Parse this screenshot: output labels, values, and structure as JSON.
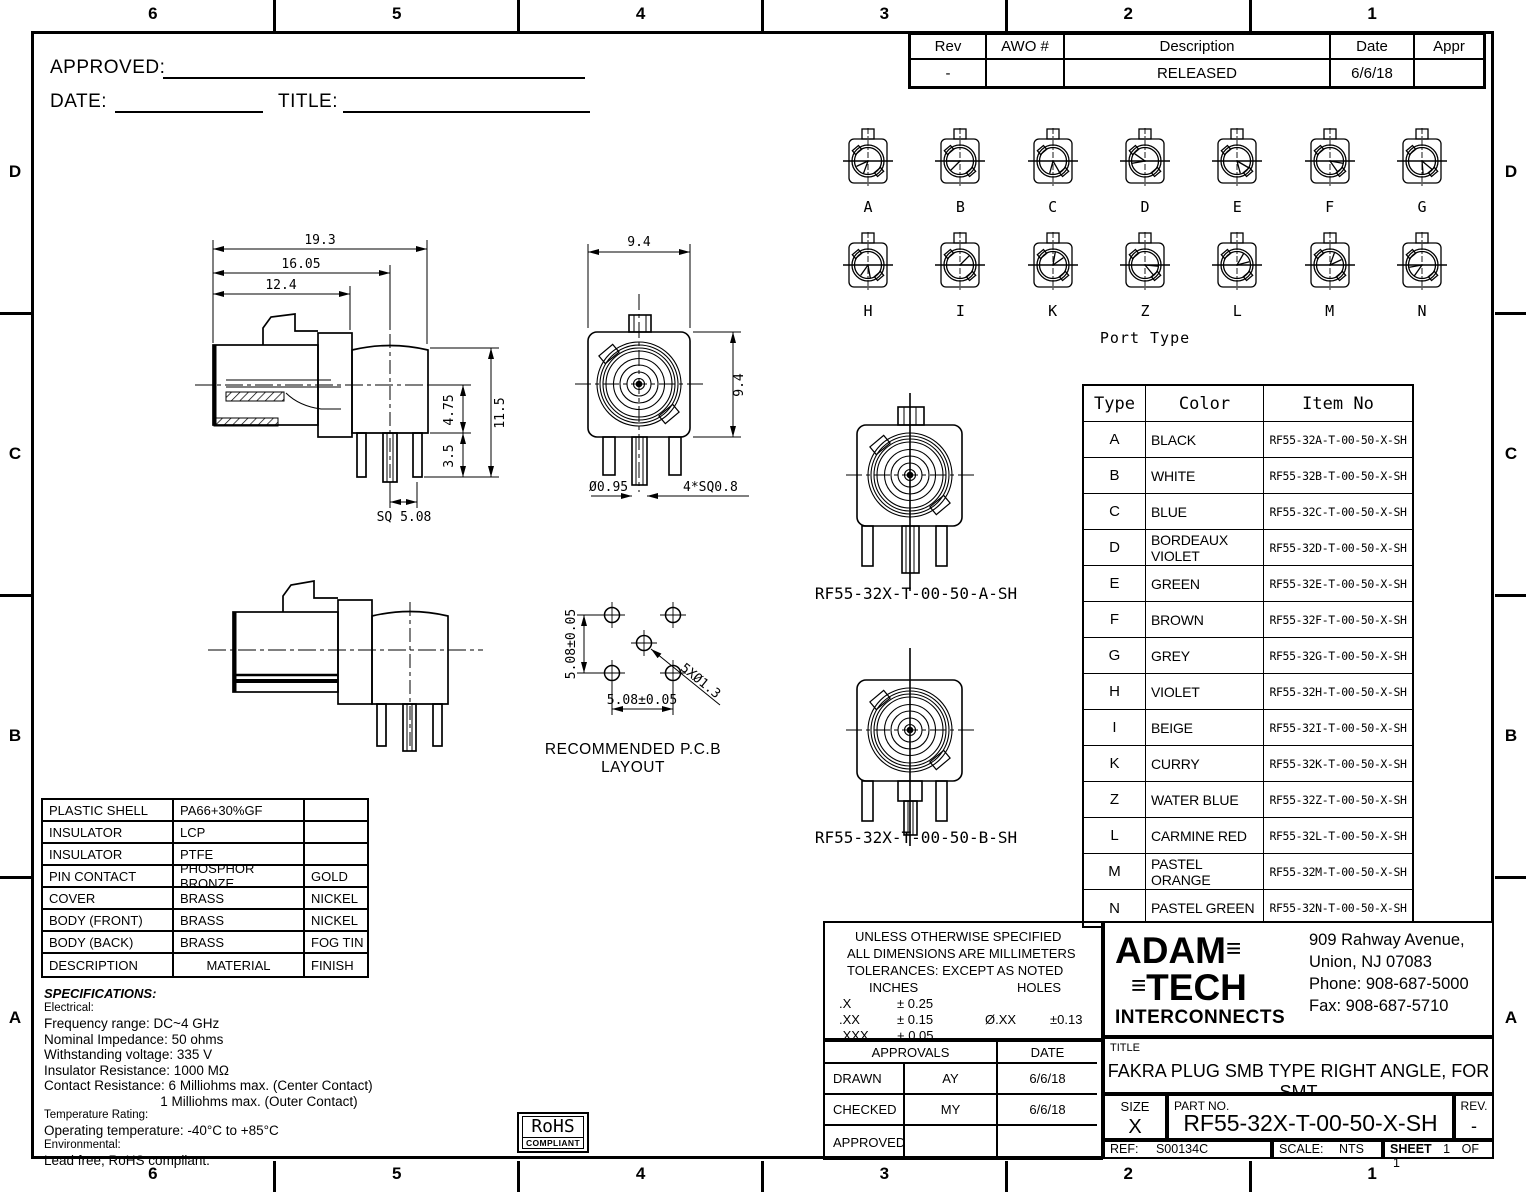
{
  "sheet": {
    "zones": {
      "cols": [
        "6",
        "5",
        "4",
        "3",
        "2",
        "1"
      ],
      "rows": [
        "D",
        "C",
        "B",
        "A"
      ]
    }
  },
  "header": {
    "approved_label": "APPROVED:",
    "date_label": "DATE:",
    "title_label": "TITLE:"
  },
  "rev_table": {
    "headers": [
      "Rev",
      "AWO #",
      "Description",
      "Date",
      "Appr"
    ],
    "rows": [
      [
        "-",
        "",
        "RELEASED",
        "6/6/18",
        ""
      ]
    ]
  },
  "port_types": {
    "caption": "Port Type",
    "row1": [
      "A",
      "B",
      "C",
      "D",
      "E",
      "F",
      "G"
    ],
    "row2": [
      "H",
      "I",
      "K",
      "Z",
      "L",
      "M",
      "N"
    ]
  },
  "dims": {
    "len_total": "19.3",
    "len_mid": "16.05",
    "len_front": "12.4",
    "h_center": "4.75",
    "h_total": "11.5",
    "leg_len": "3.5",
    "sq_pitch": "SQ 5.08",
    "fv_width": "9.4",
    "fv_height": "9.4",
    "pin_dia": "Ø0.95",
    "leg_sq": "4*SQ0.8"
  },
  "pcb": {
    "dim_v": "5.08±0.05",
    "dim_h": "5.08±0.05",
    "holes": "5XØ1.3",
    "caption": "RECOMMENDED P.C.B LAYOUT"
  },
  "variants": {
    "a_label": "RF55-32X-T-00-50-A-SH",
    "b_label": "RF55-32X-T-00-50-B-SH"
  },
  "type_table": {
    "headers": [
      "Type",
      "Color",
      "Item No"
    ],
    "rows": [
      [
        "A",
        "BLACK",
        "RF55-32A-T-00-50-X-SH"
      ],
      [
        "B",
        "WHITE",
        "RF55-32B-T-00-50-X-SH"
      ],
      [
        "C",
        "BLUE",
        "RF55-32C-T-00-50-X-SH"
      ],
      [
        "D",
        "BORDEAUX VIOLET",
        "RF55-32D-T-00-50-X-SH"
      ],
      [
        "E",
        "GREEN",
        "RF55-32E-T-00-50-X-SH"
      ],
      [
        "F",
        "BROWN",
        "RF55-32F-T-00-50-X-SH"
      ],
      [
        "G",
        "GREY",
        "RF55-32G-T-00-50-X-SH"
      ],
      [
        "H",
        "VIOLET",
        "RF55-32H-T-00-50-X-SH"
      ],
      [
        "I",
        "BEIGE",
        "RF55-32I-T-00-50-X-SH"
      ],
      [
        "K",
        "CURRY",
        "RF55-32K-T-00-50-X-SH"
      ],
      [
        "Z",
        "WATER BLUE",
        "RF55-32Z-T-00-50-X-SH"
      ],
      [
        "L",
        "CARMINE RED",
        "RF55-32L-T-00-50-X-SH"
      ],
      [
        "M",
        "PASTEL ORANGE",
        "RF55-32M-T-00-50-X-SH"
      ],
      [
        "N",
        "PASTEL GREEN",
        "RF55-32N-T-00-50-X-SH"
      ]
    ]
  },
  "materials_table": {
    "rows": [
      [
        "PLASTIC SHELL",
        "PA66+30%GF",
        ""
      ],
      [
        "INSULATOR",
        "LCP",
        ""
      ],
      [
        "INSULATOR",
        "PTFE",
        ""
      ],
      [
        "PIN CONTACT",
        "PHOSPHOR BRONZE",
        "GOLD"
      ],
      [
        "COVER",
        "BRASS",
        "NICKEL"
      ],
      [
        "BODY (FRONT)",
        "BRASS",
        "NICKEL"
      ],
      [
        "BODY (BACK)",
        "BRASS",
        "FOG TIN"
      ],
      [
        "DESCRIPTION",
        "MATERIAL",
        "FINISH"
      ]
    ]
  },
  "specifications": {
    "title": "SPECIFICATIONS:",
    "sections": [
      {
        "label": "Electrical:",
        "items": [
          "Frequency range: DC~4 GHz",
          "Nominal Impedance: 50 ohms",
          "Withstanding voltage: 335 V",
          "Insulator Resistance: 1000 MΩ",
          "Contact Resistance: 6 Milliohms max. (Center Contact)",
          "                               1 Milliohms max. (Outer Contact)"
        ]
      },
      {
        "label": "Temperature Rating:",
        "items": [
          "Operating temperature: -40°C to +85°C"
        ]
      },
      {
        "label": "Environmental:",
        "items": [
          "Lead free, RoHS compliant."
        ]
      }
    ]
  },
  "rohs": {
    "top": "RoHS",
    "bottom": "COMPLIANT"
  },
  "tolerances": {
    "line1": "UNLESS OTHERWISE SPECIFIED",
    "line2": "ALL DIMENSIONS ARE MILLIMETERS",
    "line3": "TOLERANCES: EXCEPT AS NOTED",
    "inches_label": "INCHES",
    "holes_label": "HOLES",
    "rows": [
      [
        ".X",
        "± 0.25"
      ],
      [
        ".XX",
        "± 0.15"
      ],
      [
        ".XXX",
        "+ 0.05"
      ]
    ],
    "hole_dim": "Ø.XX",
    "hole_tol": "±0.13"
  },
  "approvals": {
    "header_left": "APPROVALS",
    "header_right": "DATE",
    "rows": [
      [
        "DRAWN",
        "AY",
        "6/6/18"
      ],
      [
        "CHECKED",
        "MY",
        "6/6/18"
      ],
      [
        "APPROVED",
        "",
        ""
      ]
    ]
  },
  "company": {
    "logo_line1": "ADAM",
    "logo_line2": "TECH",
    "logo_line3": "INTERCONNECTS",
    "logo_deco": "≡",
    "address": [
      "909 Rahway Avenue,",
      "Union, NJ 07083",
      "Phone: 908-687-5000",
      "Fax: 908-687-5710"
    ]
  },
  "title_block": {
    "title_label": "TITLE",
    "title": "FAKRA PLUG SMB TYPE RIGHT ANGLE, FOR SMT",
    "size_label": "SIZE",
    "size": "X",
    "part_label": "PART NO.",
    "part_no": "RF55-32X-T-00-50-X-SH",
    "rev_label": "REV.",
    "rev": "-",
    "ref_label": "REF:",
    "ref": "S00134C",
    "scale_label": "SCALE:",
    "scale": "NTS",
    "sheet_label": "SHEET",
    "sheet_num": "1",
    "of_label": "OF",
    "sheet_total": "1"
  }
}
